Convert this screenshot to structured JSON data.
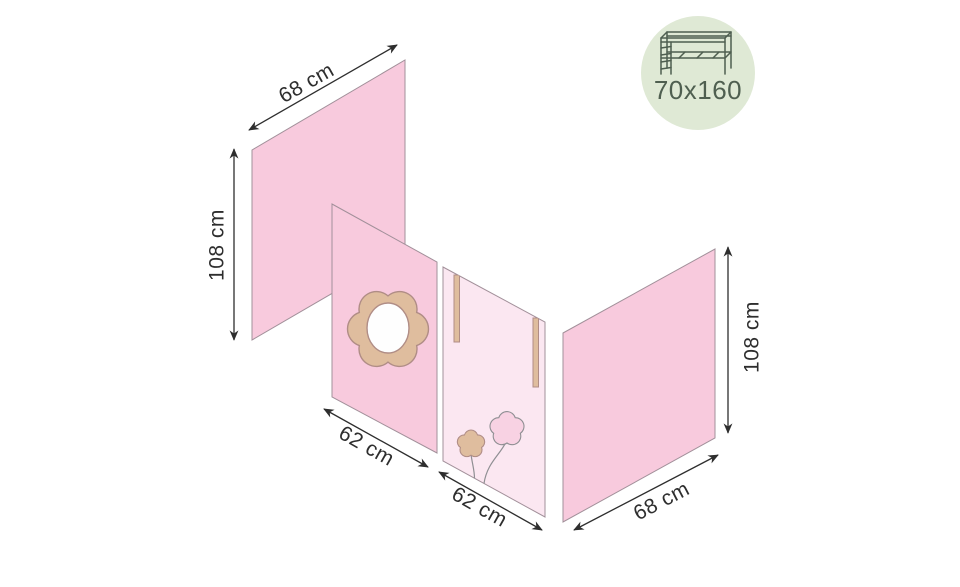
{
  "diagram": {
    "type": "product-dimension-diagram",
    "subject": "loft-bed curtain panels",
    "dimension_labels": {
      "back_left_width": "68 cm",
      "left_height": "108 cm",
      "front_left_width": "62 cm",
      "front_right_width": "62 cm",
      "back_right_width": "68 cm",
      "right_height": "108 cm"
    },
    "badge": {
      "icon": "loft-bed-icon",
      "size_text": "70x160"
    },
    "colors": {
      "background": "#ffffff",
      "panel_pink": "#f8cadd",
      "panel_pink_light": "#fbe7f1",
      "panel_outline": "#a2909a",
      "tan": "#dfbd9e",
      "tan_outline": "#b08d86",
      "window_white": "#fefefe",
      "blossom_pink": "#f8d2e3",
      "stem_gray": "#8f8f93",
      "dimension_ink": "#2e2e2e",
      "badge_bg": "#dfe9d5",
      "badge_fg": "#4f5f50"
    }
  }
}
